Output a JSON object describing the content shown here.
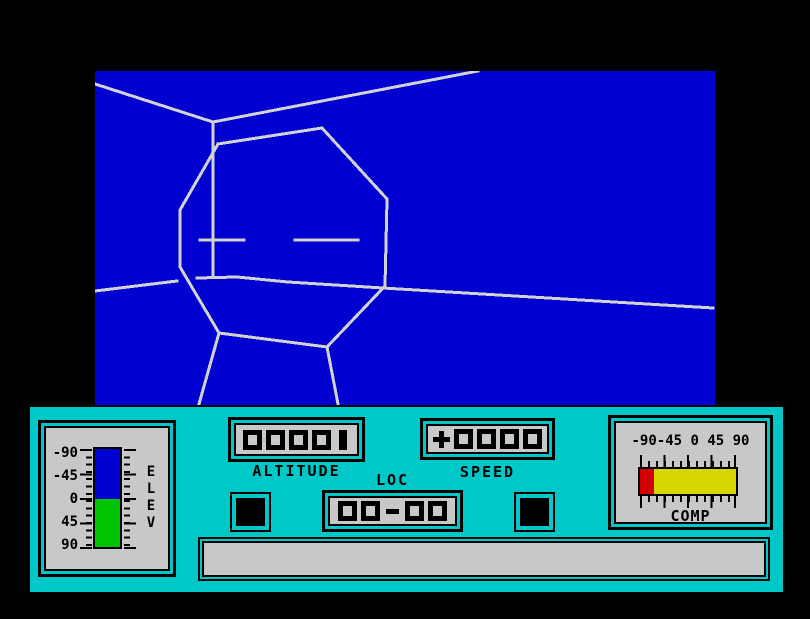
{
  "scene": {
    "view_bg": "#0000d0",
    "line_color": "#d2d2d2",
    "description": "wireframe-octagonal-face-structure-on-ground",
    "segments": [
      [
        [
          0,
          13
        ],
        [
          118,
          51
        ]
      ],
      [
        [
          118,
          51
        ],
        [
          383,
          0
        ]
      ],
      [
        [
          118,
          51
        ],
        [
          118,
          205
        ]
      ],
      [
        [
          123,
          73
        ],
        [
          227,
          57
        ],
        [
          292,
          128
        ],
        [
          290,
          215
        ],
        [
          232,
          276
        ],
        [
          124,
          262
        ],
        [
          85,
          196
        ],
        [
          85,
          139
        ],
        [
          123,
          73
        ]
      ],
      [
        [
          105,
          169
        ],
        [
          149,
          169
        ]
      ],
      [
        [
          200,
          169
        ],
        [
          263,
          169
        ]
      ],
      [
        [
          0,
          220
        ],
        [
          82,
          210
        ]
      ],
      [
        [
          102,
          207
        ],
        [
          142,
          206
        ],
        [
          193,
          211
        ],
        [
          288,
          217
        ],
        [
          618,
          237
        ]
      ],
      [
        [
          124,
          262
        ],
        [
          104,
          333
        ]
      ],
      [
        [
          232,
          276
        ],
        [
          243,
          333
        ]
      ]
    ]
  },
  "panel": {
    "bg_color": "#00c8c8",
    "face_color": "#c8c8c8",
    "elev": {
      "label": "ELEV",
      "label_vertical": "E\nL\nE\nV",
      "scale": [
        "-90",
        "-45",
        "0",
        "45",
        "90"
      ],
      "bar_top_color": "#0000d0",
      "bar_bottom_color": "#00c400"
    },
    "altitude": {
      "label": "ALTITUDE",
      "value": "00001"
    },
    "speed": {
      "label": "SPEED",
      "value": "+0000"
    },
    "loc": {
      "label": "LOC",
      "value": "00-00"
    },
    "comp": {
      "label": "COMP",
      "scale": "-90-45 0 45 90",
      "bar_left_color": "#d40000",
      "bar_right_color": "#d6d600"
    },
    "message": {
      "value": ""
    }
  }
}
